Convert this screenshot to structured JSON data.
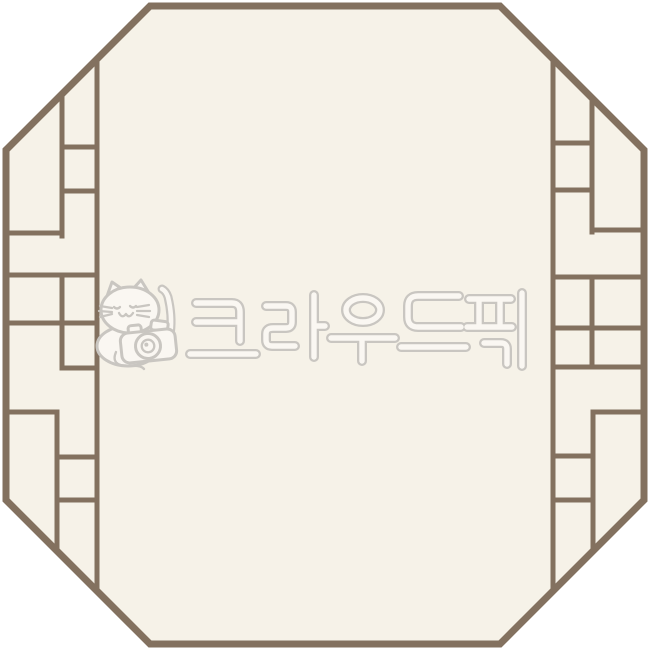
{
  "canvas": {
    "width": 650,
    "height": 650
  },
  "colors": {
    "outside": "#ffffff",
    "panel_fill": "#f6f2e8",
    "frame": "#83715f",
    "watermark_line": "#c9c6c1",
    "watermark_fill": "#faf7f2"
  },
  "frame": {
    "shape": "octagon",
    "pattern": "traditional-korean-lattice"
  },
  "watermark": {
    "text": "크라우드픽",
    "logo_icon": "cat-with-camera-icon"
  }
}
